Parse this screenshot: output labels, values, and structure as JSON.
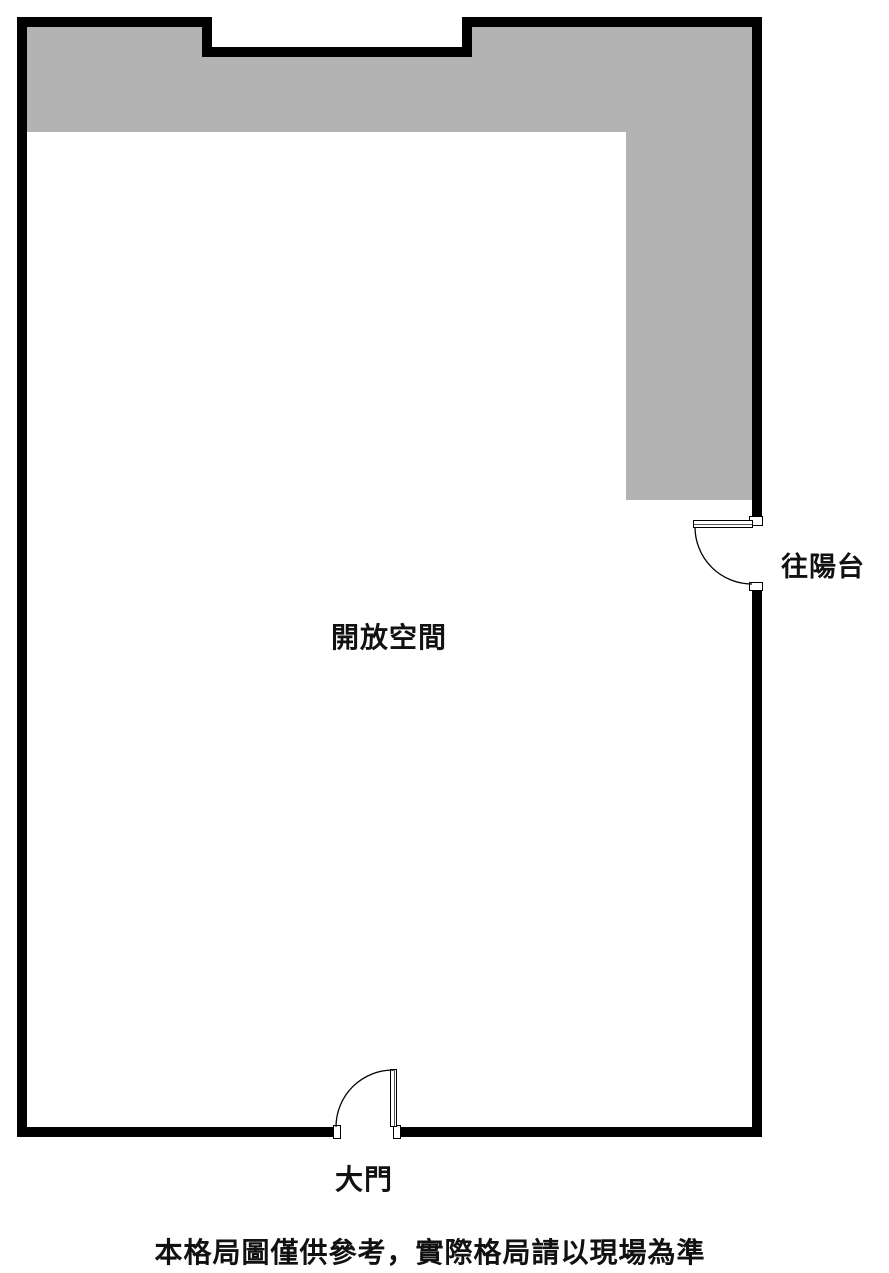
{
  "labels": {
    "open_space": "開放空間",
    "balcony_door": "往陽台",
    "main_door": "大門"
  },
  "disclaimer": "本格局圖僅供參考，實際格局請以現場為準",
  "colors": {
    "wall": "#000000",
    "shaded-area": "#b3b3b3",
    "background": "#ffffff",
    "text": "#111111"
  }
}
